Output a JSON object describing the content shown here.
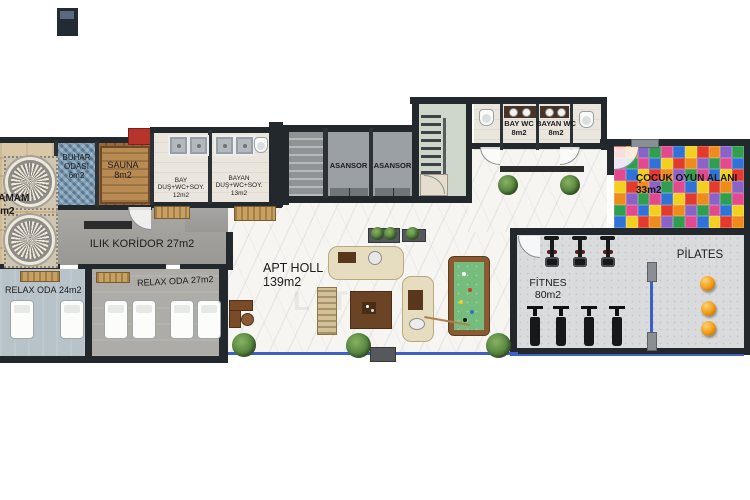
{
  "rooms": {
    "hamam": {
      "name": "HAMAM",
      "area": "25m2"
    },
    "buhar": {
      "name": "BUHAR ODASI",
      "area": "6m2"
    },
    "sauna": {
      "name": "SAUNA",
      "area": "8m2"
    },
    "bay_dus": {
      "name": "BAY",
      "detail": "DUŞ+WC+SOY.",
      "area": "12m2"
    },
    "bayan_dus": {
      "name": "BAYAN",
      "detail": "DUŞ+WC+SOY.",
      "area": "13m2"
    },
    "ilik_koridor": {
      "name": "ILIK KORİDOR",
      "area": "27m2"
    },
    "relax24": {
      "name": "RELAX ODA",
      "area": "24m2"
    },
    "relax27": {
      "name": "RELAX ODA",
      "area": "27m2"
    },
    "apt_holl": {
      "name": "APT HOLL",
      "area": "139m2"
    },
    "asansor1": {
      "name": "ASANSOR"
    },
    "asansor2": {
      "name": "ASANSOR"
    },
    "bay_wc": {
      "name": "BAY WC",
      "area": "8m2"
    },
    "bayan_wc": {
      "name": "BAYAN WC",
      "area": "8m2"
    },
    "cocuk": {
      "name": "ÇOCUK OYUN ALANI",
      "area": "33m2"
    },
    "fitnes": {
      "name": "FİTNES",
      "area": "80m2"
    },
    "pilates": {
      "name": "PİLATES"
    }
  },
  "watermark": "LITU",
  "colors": {
    "wall": "#23282c",
    "marble": "#f6f5f2",
    "warm_corridor": "#a3a19c",
    "relax24_floor": "#b7c3c8",
    "relax27_floor": "#aeaca7",
    "hamam_floor": "#d9c7a5",
    "sauna_wood": "#96683c",
    "steam_mosaic": "#6f93ae",
    "shower_floor": "#eae6dd",
    "gym_floor": "#d9dbdd",
    "pool_felt": "#76bd7d",
    "pilates_ball": "#f2990f",
    "glass_blue": "#3d5fc6",
    "sauna_heater_red": "#b5342b",
    "mat_palette": [
      "#e23b2e",
      "#2f9e4f",
      "#f3cf1f",
      "#8a63c9",
      "#2f73d8",
      "#ef8b1d",
      "#e2498f"
    ]
  }
}
